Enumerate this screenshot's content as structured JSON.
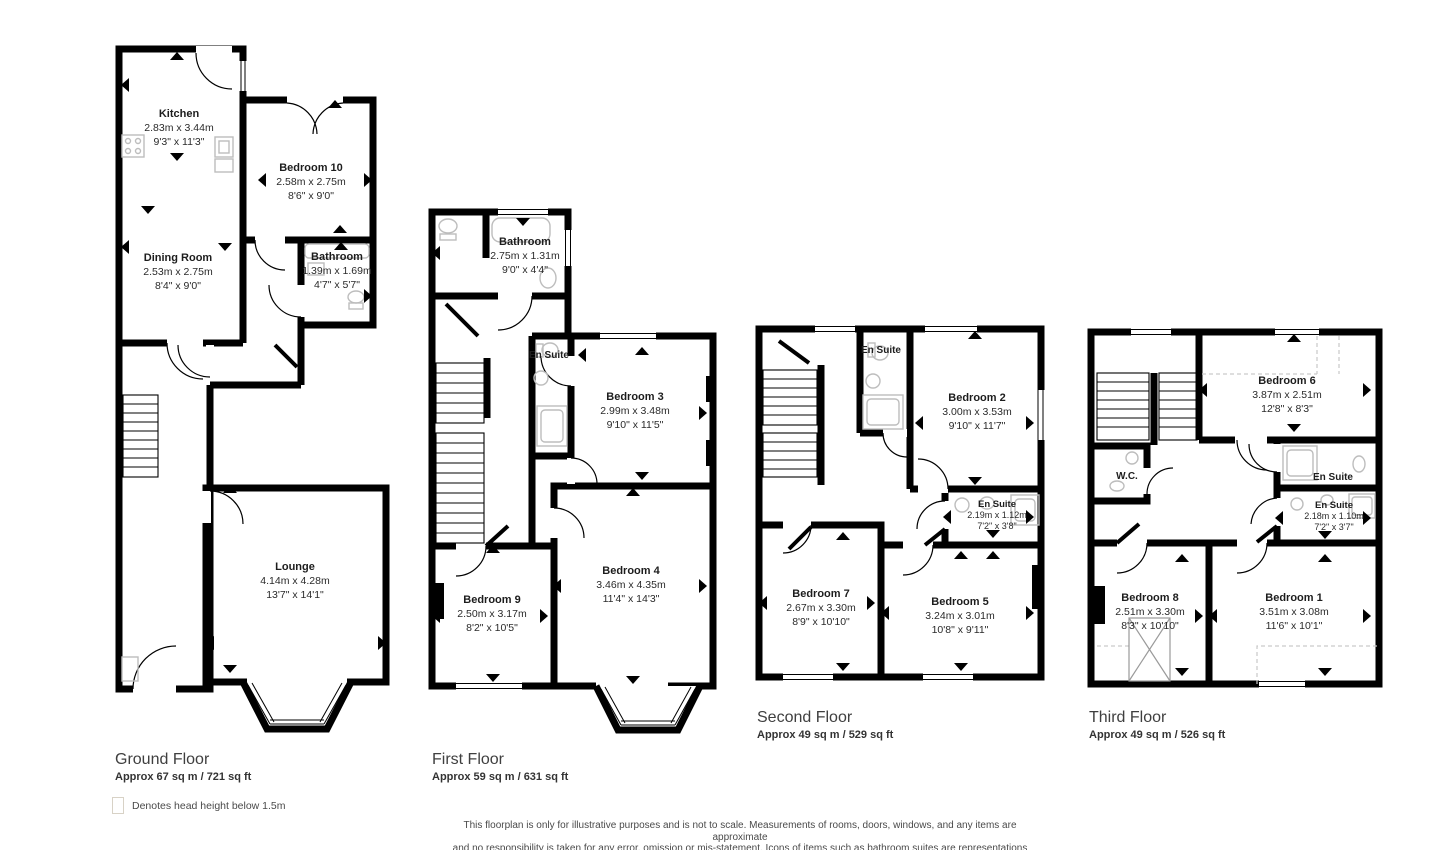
{
  "colors": {
    "wall": "#000000",
    "fixture": "#bdbdbd",
    "text": "#222222",
    "title": "#3f3f3f"
  },
  "legend": {
    "label": "Denotes head height below 1.5m"
  },
  "disclaimer": {
    "line1": "This floorplan is only for illustrative purposes and is not to scale. Measurements of rooms, doors, windows, and any items are approximate",
    "line2": "and no responsibility is taken for any error, omission or mis-statement. Icons of items such as bathroom suites are representations only and",
    "line3": "may not look like the real items. Made with Made Snappy 360."
  },
  "floors": [
    {
      "name": "Ground Floor",
      "area": "Approx 67 sq m / 721 sq ft",
      "rooms": [
        {
          "name": "Kitchen",
          "metric": "2.83m x 3.44m",
          "imperial": "9'3\" x 11'3\""
        },
        {
          "name": "Bedroom 10",
          "metric": "2.58m x 2.75m",
          "imperial": "8'6\" x 9'0\""
        },
        {
          "name": "Bathroom",
          "metric": "1.39m x 1.69m",
          "imperial": "4'7\" x 5'7\""
        },
        {
          "name": "Dining Room",
          "metric": "2.53m x 2.75m",
          "imperial": "8'4\" x 9'0\""
        },
        {
          "name": "Lounge",
          "metric": "4.14m x 4.28m",
          "imperial": "13'7\" x 14'1\""
        }
      ]
    },
    {
      "name": "First Floor",
      "area": "Approx 59 sq m / 631 sq ft",
      "rooms": [
        {
          "name": "Bathroom",
          "metric": "2.75m x 1.31m",
          "imperial": "9'0\" x 4'4\""
        },
        {
          "name": "En Suite",
          "metric": "",
          "imperial": ""
        },
        {
          "name": "Bedroom 3",
          "metric": "2.99m x 3.48m",
          "imperial": "9'10\" x 11'5\""
        },
        {
          "name": "Bedroom 9",
          "metric": "2.50m x 3.17m",
          "imperial": "8'2\" x 10'5\""
        },
        {
          "name": "Bedroom 4",
          "metric": "3.46m x 4.35m",
          "imperial": "11'4\" x 14'3\""
        }
      ]
    },
    {
      "name": "Second Floor",
      "area": "Approx 49 sq m / 529 sq ft",
      "rooms": [
        {
          "name": "En Suite",
          "metric": "",
          "imperial": ""
        },
        {
          "name": "Bedroom 2",
          "metric": "3.00m x 3.53m",
          "imperial": "9'10\" x 11'7\""
        },
        {
          "name": "En Suite",
          "metric": "2.19m x 1.12m",
          "imperial": "7'2\" x 3'8\""
        },
        {
          "name": "Bedroom 7",
          "metric": "2.67m x 3.30m",
          "imperial": "8'9\" x 10'10\""
        },
        {
          "name": "Bedroom 5",
          "metric": "3.24m x 3.01m",
          "imperial": "10'8\" x 9'11\""
        }
      ]
    },
    {
      "name": "Third Floor",
      "area": "Approx 49 sq m / 526 sq ft",
      "rooms": [
        {
          "name": "Bedroom 6",
          "metric": "3.87m x 2.51m",
          "imperial": "12'8\" x 8'3\""
        },
        {
          "name": "W.C.",
          "metric": "",
          "imperial": ""
        },
        {
          "name": "En Suite",
          "metric": "",
          "imperial": ""
        },
        {
          "name": "En Suite",
          "metric": "2.18m x 1.10m",
          "imperial": "7'2\" x 3'7\""
        },
        {
          "name": "Bedroom 8",
          "metric": "2.51m x 3.30m",
          "imperial": "8'3\" x 10'10\""
        },
        {
          "name": "Bedroom 1",
          "metric": "3.51m x 3.08m",
          "imperial": "11'6\" x 10'1\""
        }
      ]
    }
  ]
}
